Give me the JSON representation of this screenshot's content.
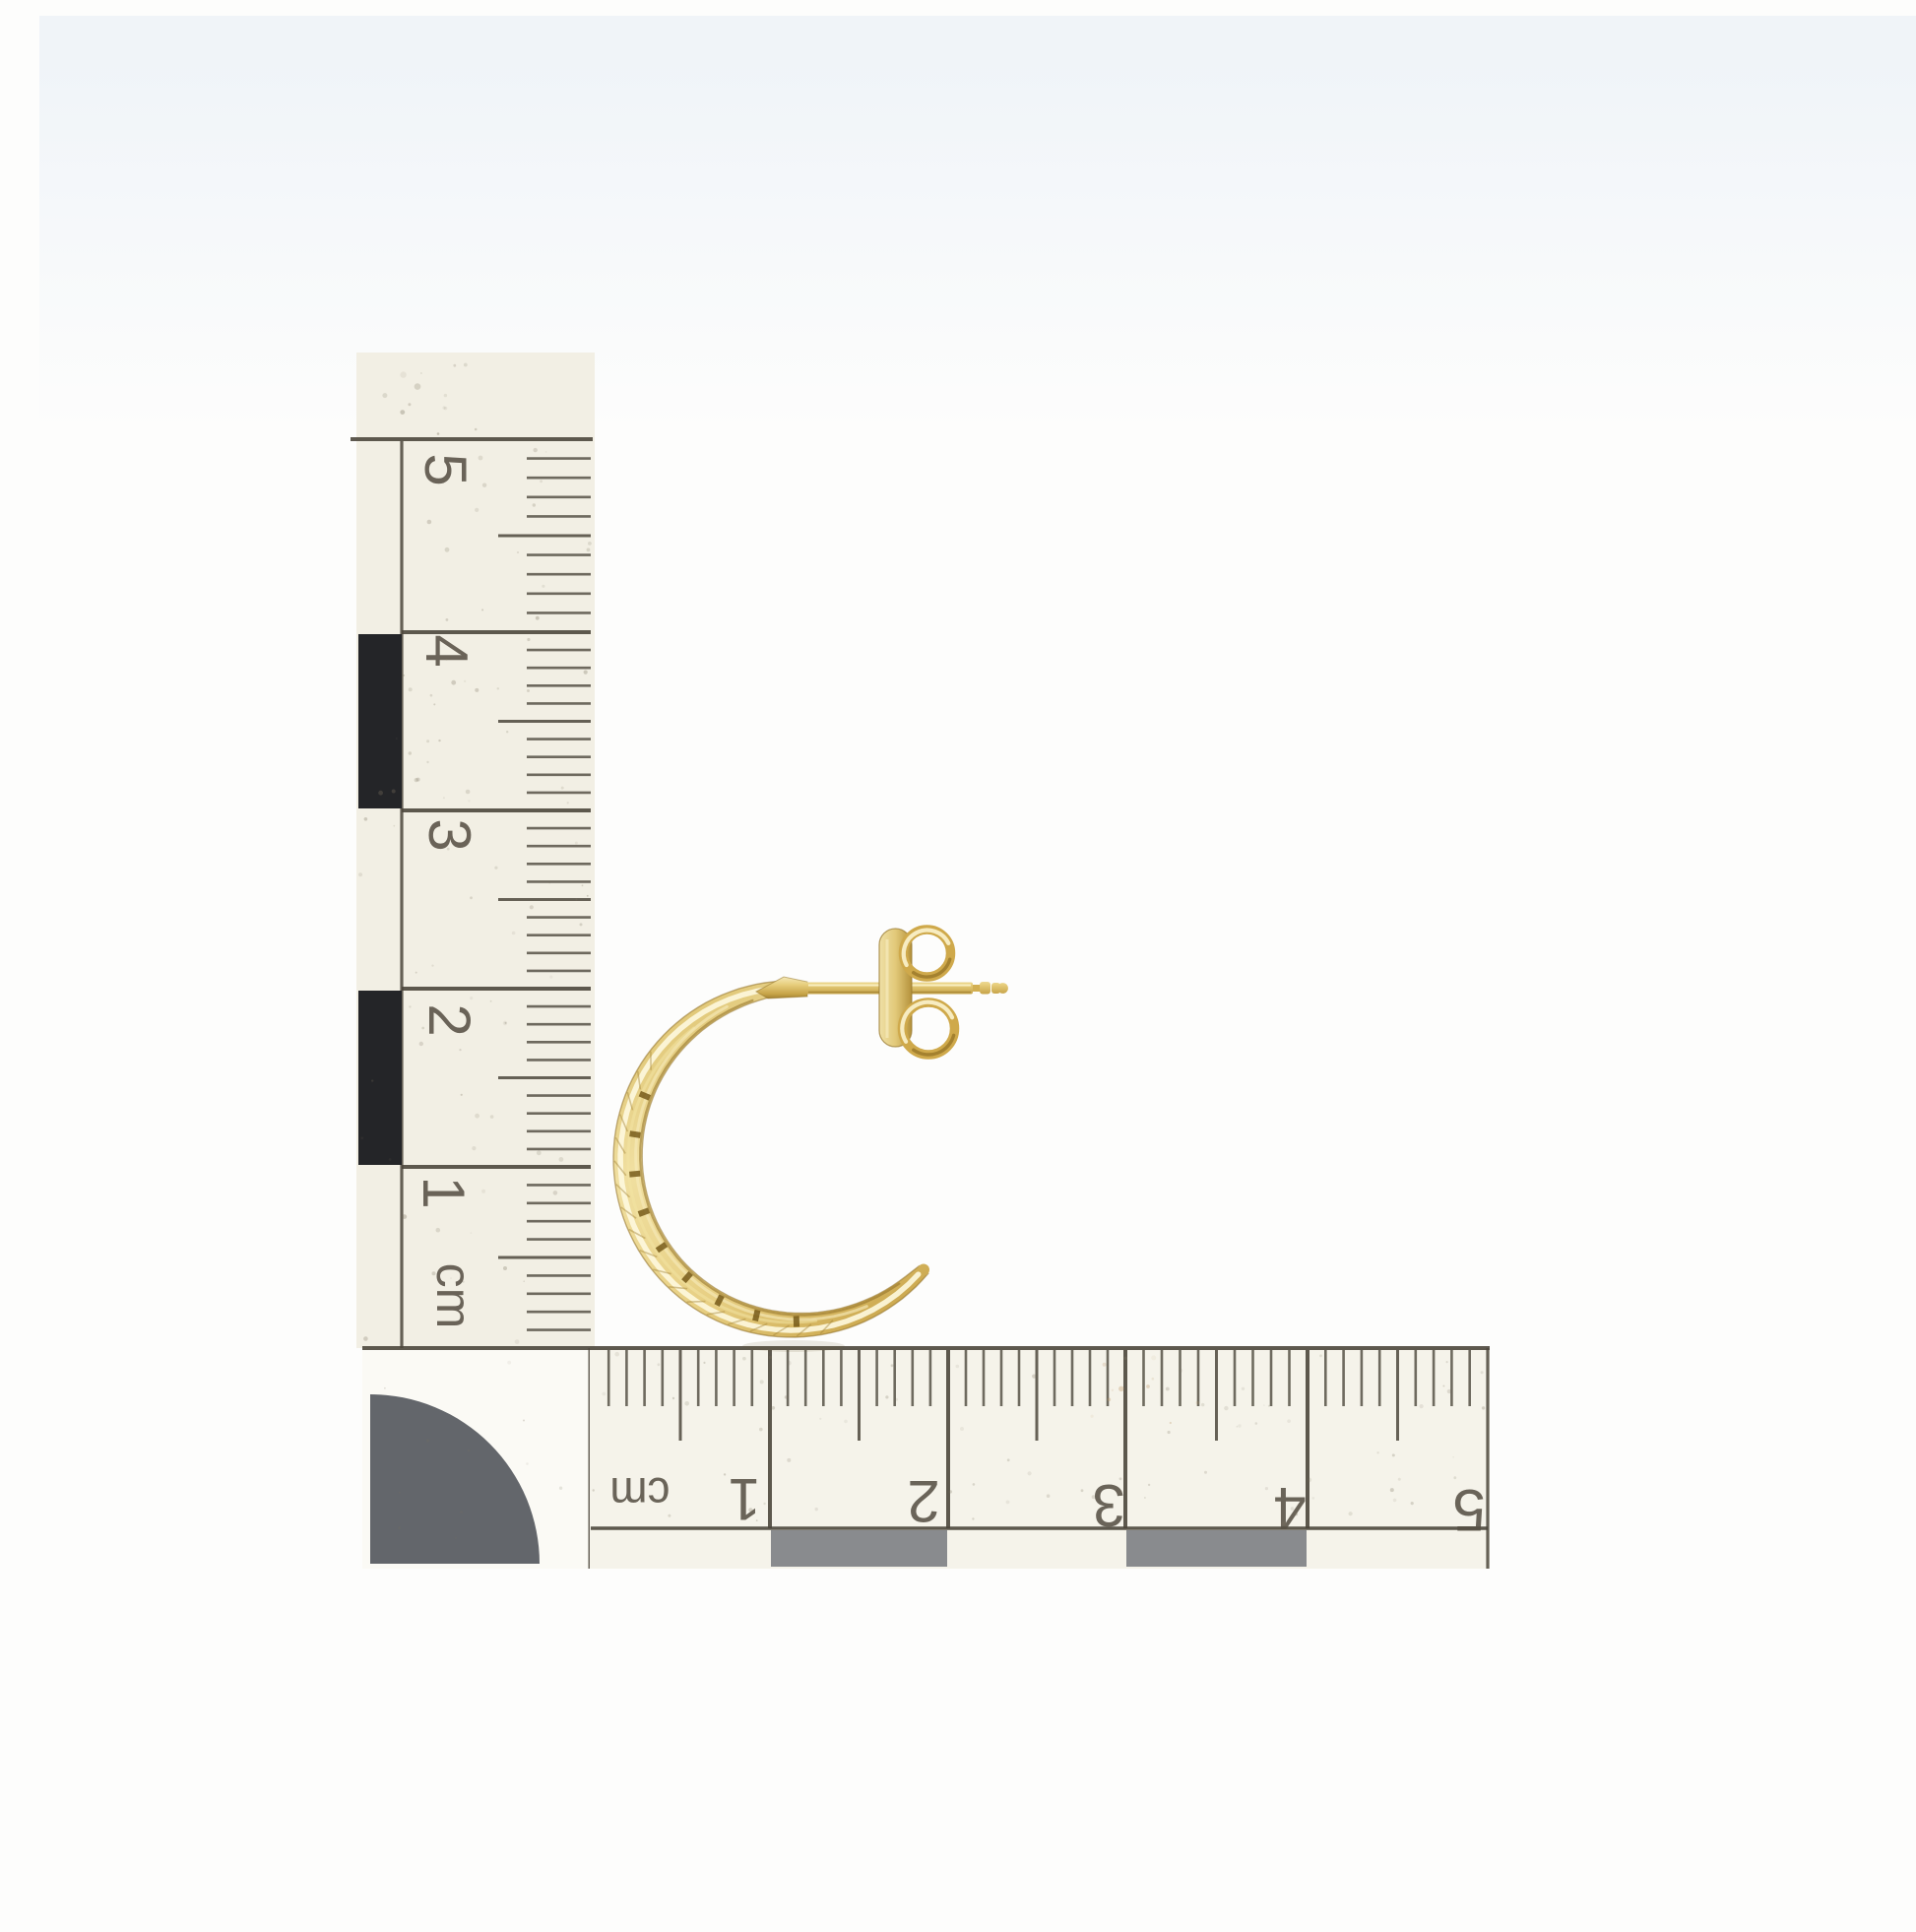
{
  "photo": {
    "subject": "Yellow gold open hoop stud earring with butterfly back photographed beside centimetre scale rulers",
    "background_color": "#fdfdfc"
  },
  "colors": {
    "ink": "#4c473c",
    "label": "#565044",
    "ruler_cream_vertical": "#f2efe4",
    "ruler_cream_horizontal": "#f5f3ea",
    "corner_bg": "#fbfaf5",
    "block_dark": "#242528",
    "block_gray": "#898b8e",
    "disc_gray": "#63666b",
    "speck": "#7c7460",
    "speck_tan": "#c0996a",
    "top_tint": "#dfe9f4",
    "shadow": "#6b5d33",
    "gold_edge": "#8f7026",
    "gold_slot": "#6f5311",
    "gold_hatch": "#a5843a",
    "gold_highlight": "#fdf7dc",
    "gold_highlight2": "#f3e3a2",
    "band_stop1": "#d7b95f",
    "band_stop2": "#f0dfa0",
    "band_stop3": "#e7cf83",
    "band_stop4": "#c7a246",
    "post_stop1": "#f6ecc0",
    "post_stop2": "#e8cf7e",
    "post_stop3": "#c5a246",
    "post_stop4": "#8f6f26",
    "plate_stop1": "#efe0a6",
    "plate_stop2": "#e2c979",
    "plate_stop3": "#b5923c",
    "ring_base": "#cfa94b",
    "ring_highlight": "#f9efc7",
    "ring_shadow": "#927023"
  },
  "vertical_ruler": {
    "unit": "cm",
    "numbers": [
      "5",
      "4",
      "3",
      "2",
      "1"
    ]
  },
  "horizontal_ruler": {
    "unit": "cm",
    "numbers": [
      "1",
      "2",
      "3",
      "4",
      "5"
    ]
  }
}
